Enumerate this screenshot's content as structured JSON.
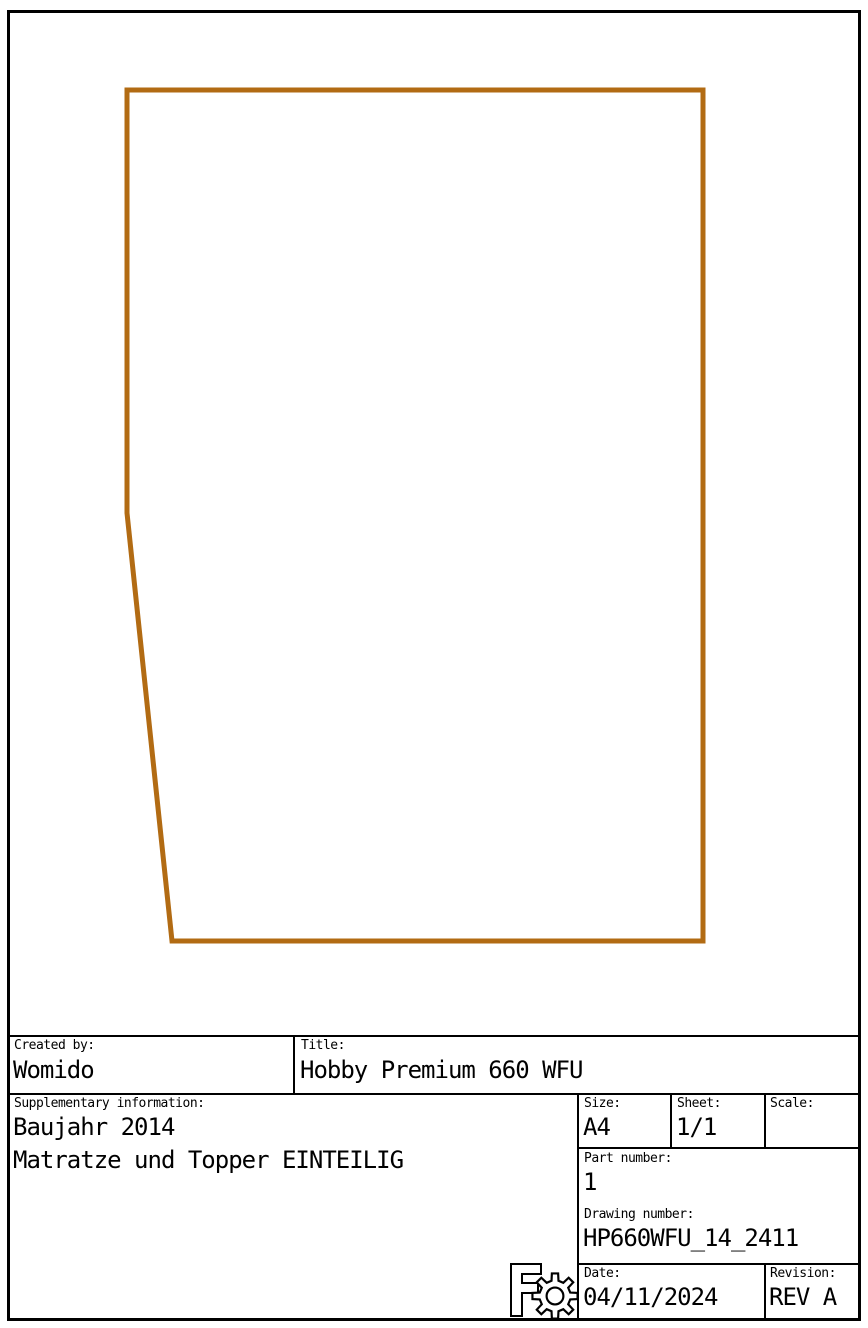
{
  "drawing": {
    "outline_points": "127,90 703,90 703,941 172,941 127,513",
    "outline_color": "#B26B13",
    "outline_stroke_width": "5",
    "shape_name": "mattress-outline-polygon"
  },
  "title_block": {
    "created_by": {
      "label": "Created by:",
      "value": "Womido"
    },
    "title": {
      "label": "Title:",
      "value": "Hobby Premium 660 WFU"
    },
    "supplementary": {
      "label": "Supplementary information:",
      "line1": "Baujahr 2014",
      "line2": "Matratze und Topper EINTEILIG"
    },
    "size": {
      "label": "Size:",
      "value": "A4"
    },
    "sheet": {
      "label": "Sheet:",
      "value": "1/1"
    },
    "scale": {
      "label": "Scale:",
      "value": ""
    },
    "part_number": {
      "label": "Part number:",
      "value": "1"
    },
    "drawing_number": {
      "label": "Drawing number:",
      "value": "HP660WFU_14_2411"
    },
    "date": {
      "label": "Date:",
      "value": "04/11/2024"
    },
    "revision": {
      "label": "Revision:",
      "value": "REV A"
    },
    "logo_icon": "freecad-gear-logo"
  }
}
